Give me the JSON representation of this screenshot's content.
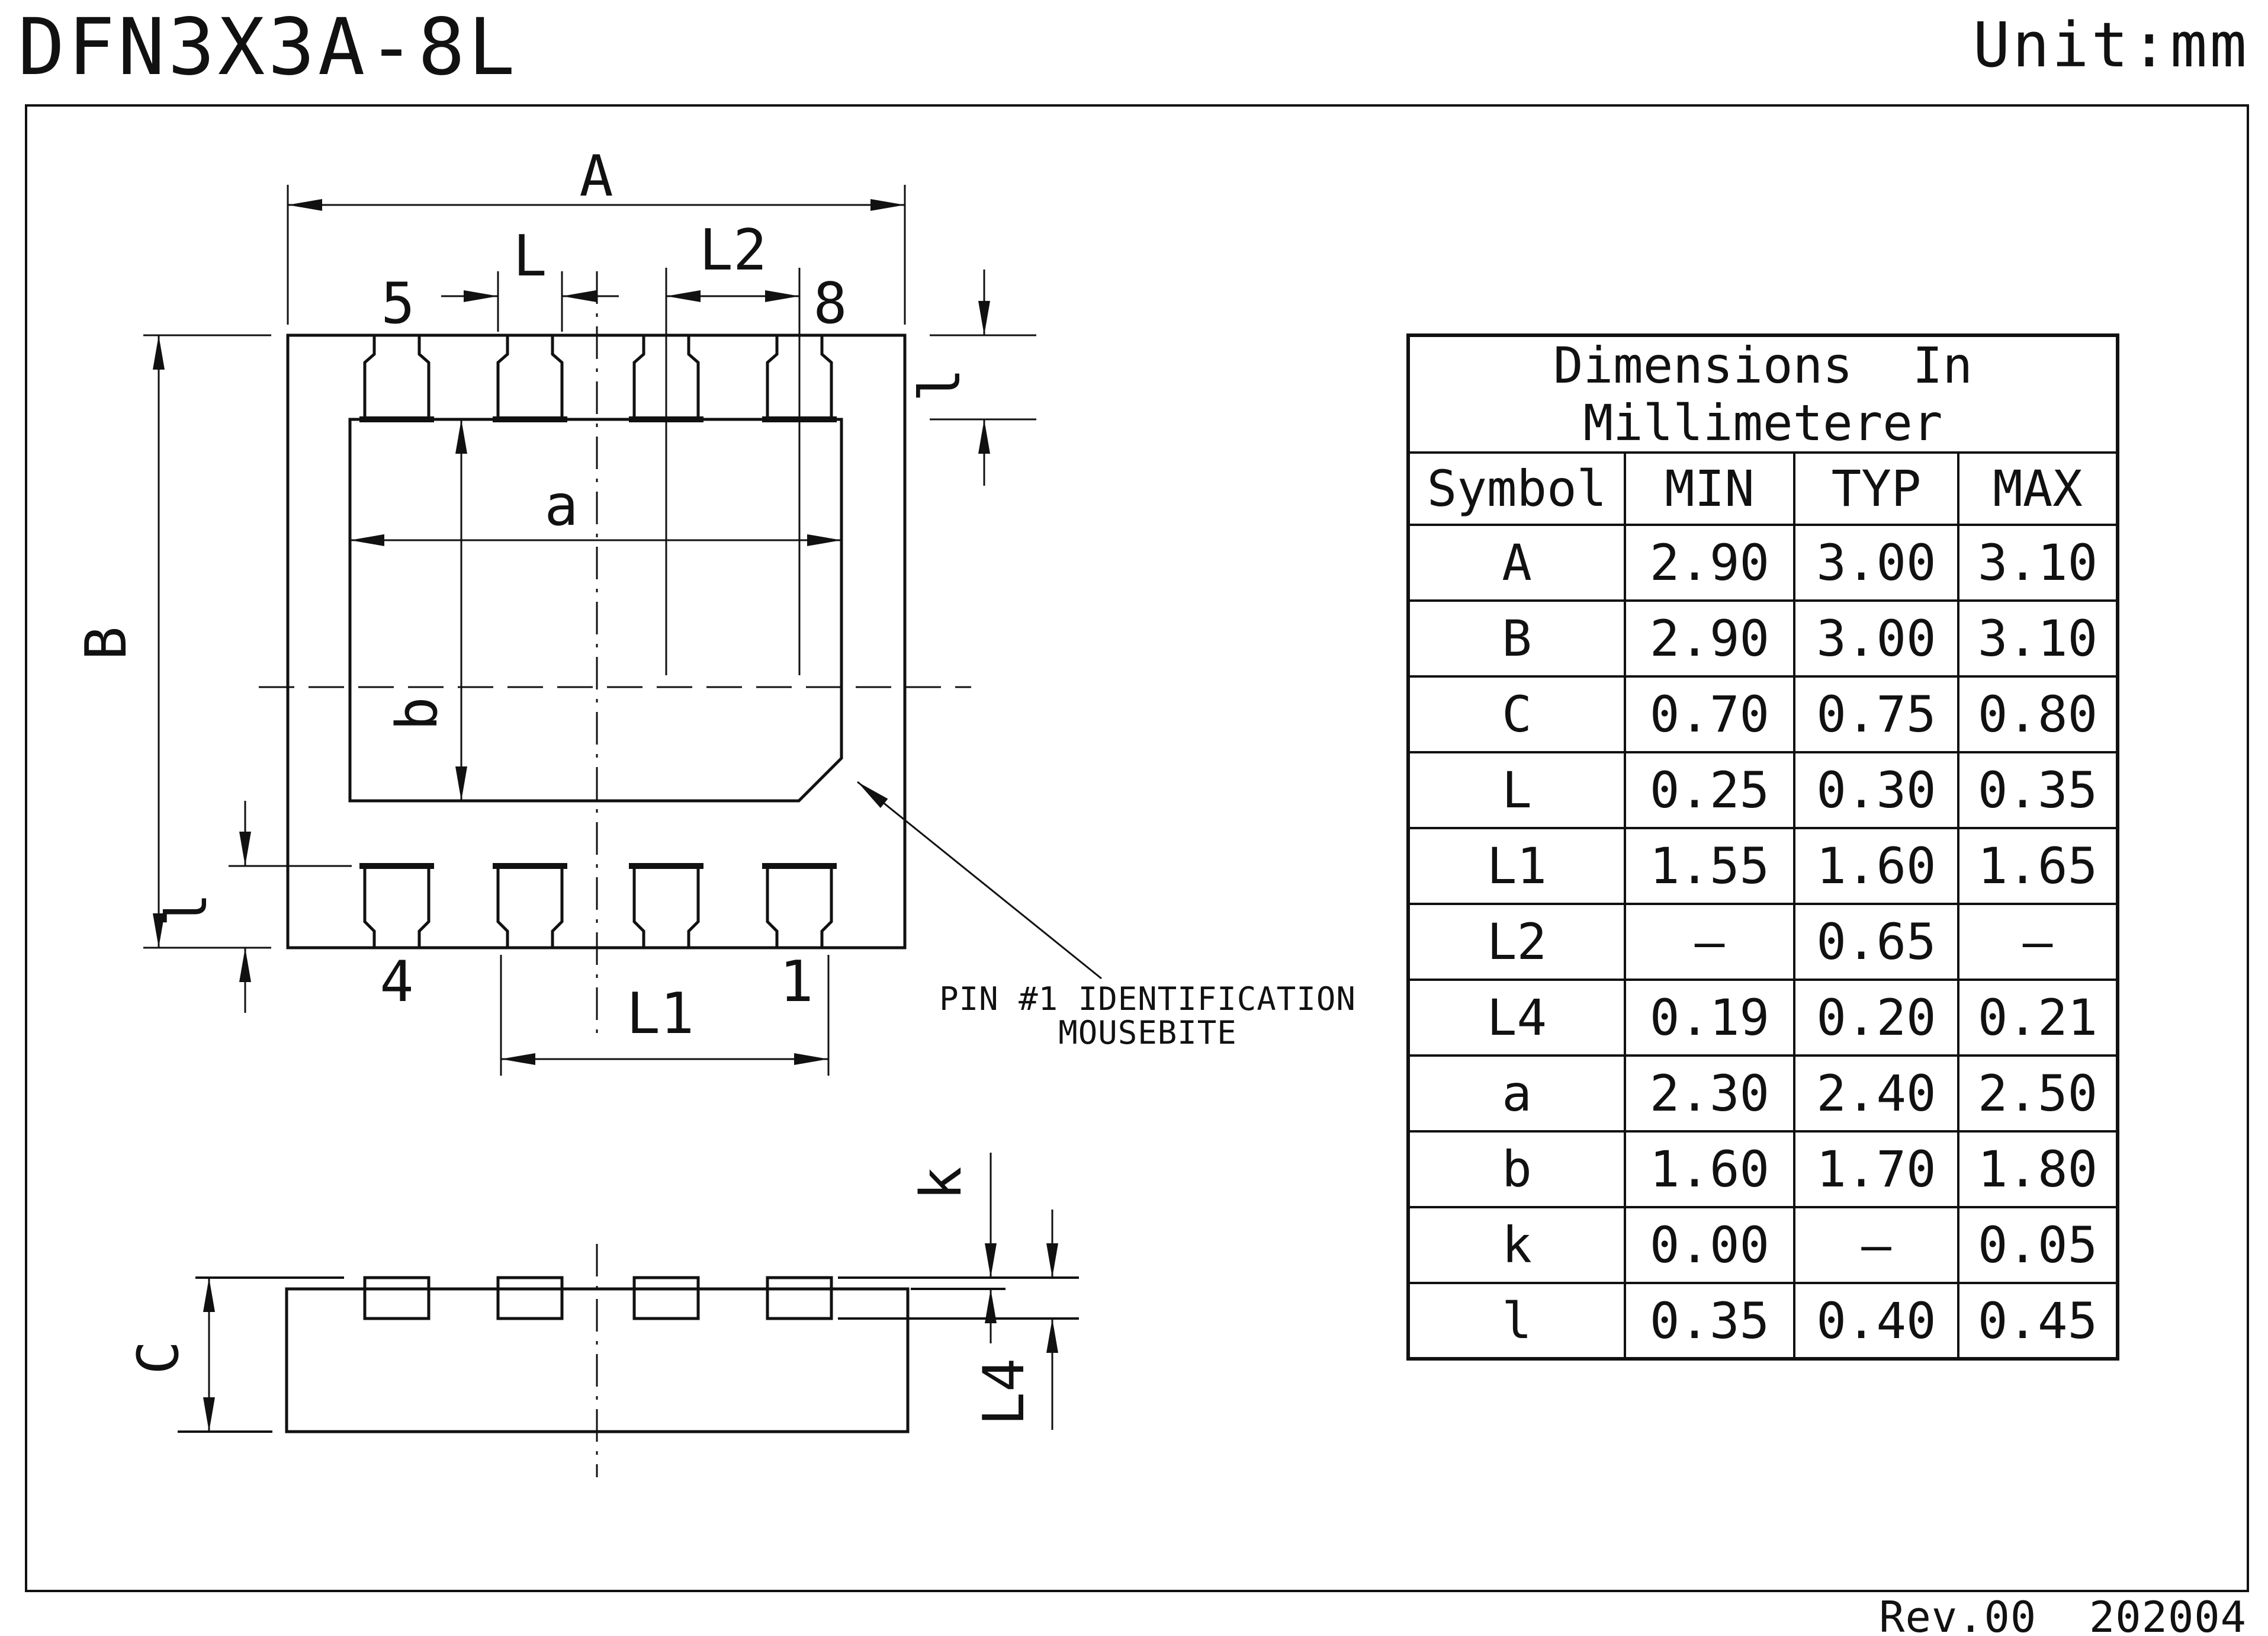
{
  "page": {
    "title": "DFN3X3A-8L",
    "unit": "Unit:mm",
    "revision": "Rev.00  202004"
  },
  "drawing": {
    "labels": {
      "dim_A": "A",
      "dim_B": "B",
      "dim_L": "L",
      "dim_L1": "L1",
      "dim_L2": "L2",
      "dim_L4": "L4",
      "dim_C": "C",
      "dim_k": "k",
      "dim_l": "l",
      "dim_a": "a",
      "dim_b": "b",
      "pin5": "5",
      "pin8": "8",
      "pin4": "4",
      "pin1": "1",
      "note_line1": "PIN #1 IDENTIFICATION",
      "note_line2": "MOUSEBITE"
    },
    "line_color": "#111111",
    "background": "#ffffff"
  },
  "table": {
    "title_line1": "Dimensions  In",
    "title_line2": "Millimeterer",
    "headers": [
      "Symbol",
      "MIN",
      "TYP",
      "MAX"
    ],
    "rows": [
      {
        "symbol": "A",
        "min": "2.90",
        "typ": "3.00",
        "max": "3.10"
      },
      {
        "symbol": "B",
        "min": "2.90",
        "typ": "3.00",
        "max": "3.10"
      },
      {
        "symbol": "C",
        "min": "0.70",
        "typ": "0.75",
        "max": "0.80"
      },
      {
        "symbol": "L",
        "min": "0.25",
        "typ": "0.30",
        "max": "0.35"
      },
      {
        "symbol": "L1",
        "min": "1.55",
        "typ": "1.60",
        "max": "1.65"
      },
      {
        "symbol": "L2",
        "min": "–",
        "typ": "0.65",
        "max": "–"
      },
      {
        "symbol": "L4",
        "min": "0.19",
        "typ": "0.20",
        "max": "0.21"
      },
      {
        "symbol": "a",
        "min": "2.30",
        "typ": "2.40",
        "max": "2.50"
      },
      {
        "symbol": "b",
        "min": "1.60",
        "typ": "1.70",
        "max": "1.80"
      },
      {
        "symbol": "k",
        "min": "0.00",
        "typ": "–",
        "max": "0.05"
      },
      {
        "symbol": "l",
        "min": "0.35",
        "typ": "0.40",
        "max": "0.45"
      }
    ]
  }
}
